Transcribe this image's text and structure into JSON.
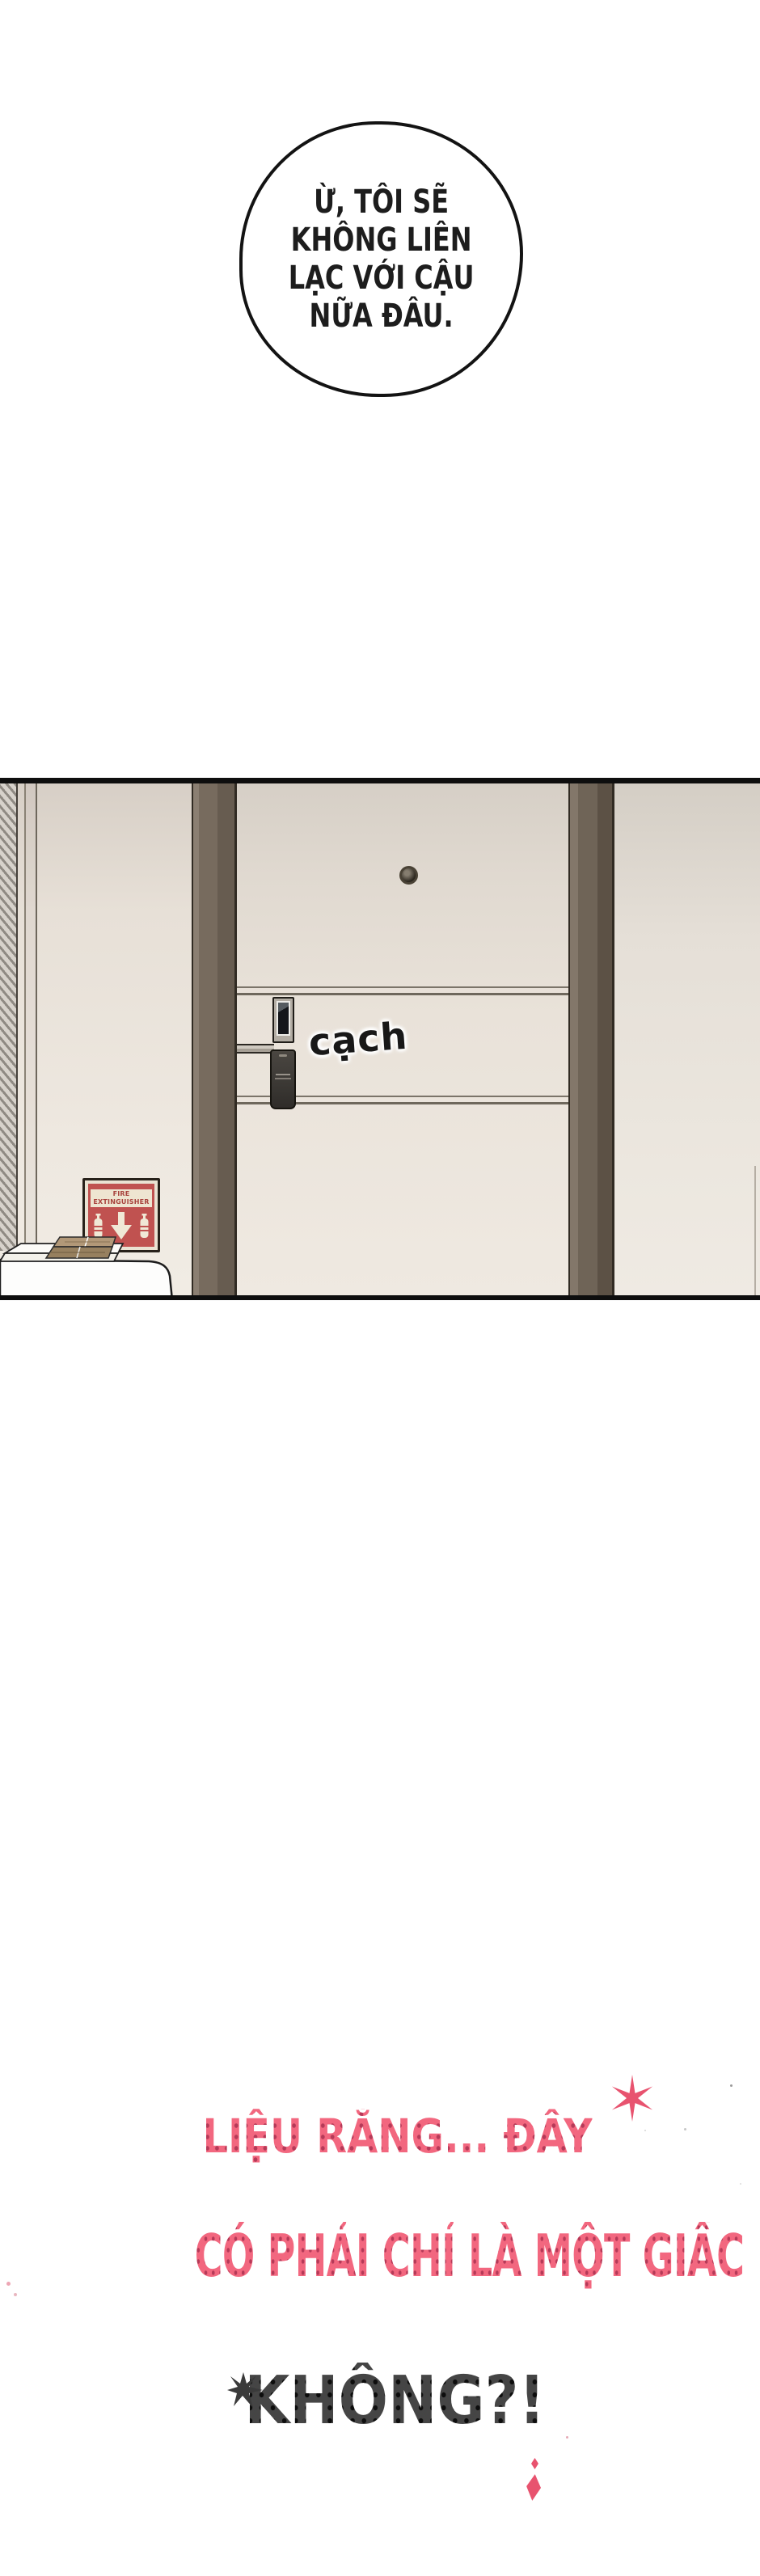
{
  "speech_bubble": {
    "lines": [
      "Ừ, TÔI SẼ",
      "KHÔNG LIÊN",
      "LẠC VỚI CẬU",
      "NỮA ĐÂU."
    ]
  },
  "panel": {
    "sfx_label": "cạch",
    "fire_sign_label": "FIRE EXTINGUISHER"
  },
  "caption": {
    "line1": "LIỆU RẰNG... ĐÂY",
    "line2": "CÓ PHẢI CHỈ LÀ MỘT GIẤC MƠ..",
    "line3": "KHÔNG?!"
  },
  "colors": {
    "caption_pink": "#f2677f",
    "caption_pink_dots": "#b53a58",
    "caption_dark": "#454545",
    "caption_dark_dots": "#0d0d0d",
    "sparkle_pink": "#e8536f",
    "sign_red": "#c05250",
    "sign_cream": "#eee5d1",
    "door_frame_brown": "#6e6356",
    "wall_beige": "#e6dfd6"
  }
}
